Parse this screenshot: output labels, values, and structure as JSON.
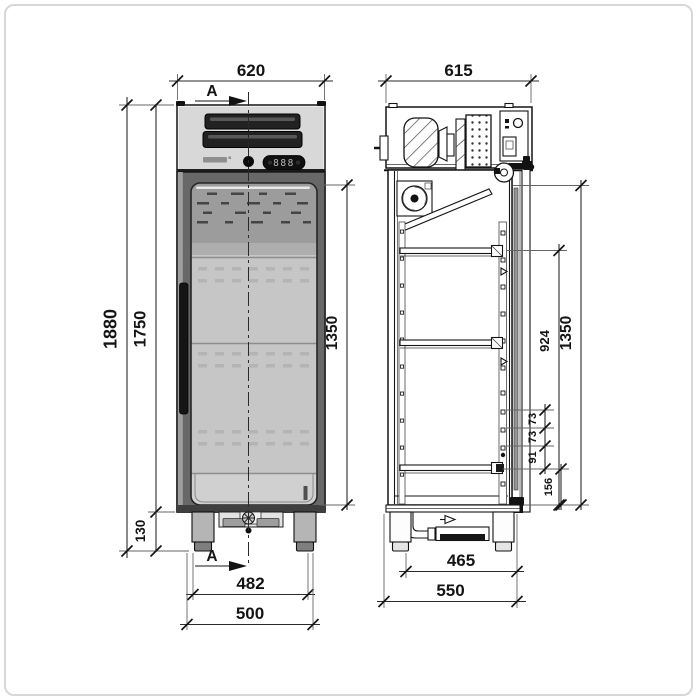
{
  "drawing_type": "refrigerator-technical-drawing",
  "section_marks": {
    "top": "A",
    "bottom": "A"
  },
  "control_panel": {
    "display_value": "888"
  },
  "front_view": {
    "width_top": "620",
    "height_total": "1880",
    "height_body": "1750",
    "door_glass_height": "1350",
    "leg_height": "130",
    "base_width_inner": "482",
    "base_width_outer": "500"
  },
  "side_view": {
    "depth_top": "615",
    "door_height": "1350",
    "shelf_zone_height": "924",
    "hole_pitch_top": "73",
    "hole_pitch_mid": "73",
    "hole_pitch_bottom": "91",
    "bottom_clearance": "156",
    "base_depth_inner": "465",
    "base_depth_outer": "550"
  }
}
